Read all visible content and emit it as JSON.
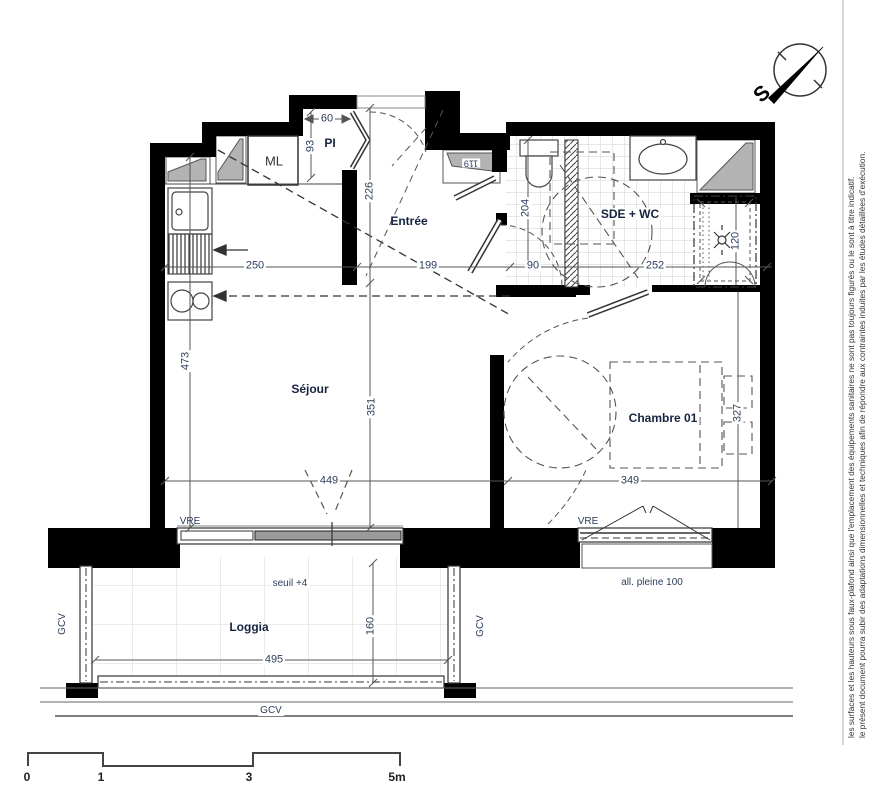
{
  "plan_title": "floor-plan",
  "rooms": {
    "pi": "PI",
    "ml": "ML",
    "entree": "Entrée",
    "sejour": "Séjour",
    "sde_wc": "SDE + WC",
    "chambre": "Chambre 01",
    "loggia": "Loggia"
  },
  "annotations": {
    "seuil": "seuil +4",
    "allege": "all. pleine 100",
    "vre_sejour": "VRE",
    "vre_chambre": "VRE",
    "gcv_left": "GCV",
    "gcv_right": "GCV",
    "gcv_bottom": "GCV"
  },
  "dimensions_cm": {
    "d60": "60",
    "d93": "93",
    "d119": "119",
    "d226": "226",
    "d250": "250",
    "d199": "199",
    "d90": "90",
    "d252": "252",
    "d204": "204",
    "d120": "120",
    "d473": "473",
    "d351": "351",
    "d449": "449",
    "d349": "349",
    "d327": "327",
    "d495": "495",
    "d160": "160"
  },
  "scale_bar": {
    "t0": "0",
    "t1": "1",
    "t3": "3",
    "t5": "5m"
  },
  "compass": {
    "south_label": "S"
  },
  "disclaimer": {
    "line1": "le présent document pourra subir des adaptations dimensionnelles et techniques afin de répondre aux contraintes induites par les études détaillées d'exécution.",
    "line2": "les surfaces et les hauteurs sous faux-plafond ainsi que l'emplacement des équipements sanitaires ne sont pas toujours figurés ou le sont à titre indicatif."
  },
  "colors": {
    "wall": "#000000",
    "line": "#4d4d4d",
    "text": "#2c3e5d",
    "grey_fill": "#b3b3b3",
    "tile_line": "#cfcfcf"
  }
}
